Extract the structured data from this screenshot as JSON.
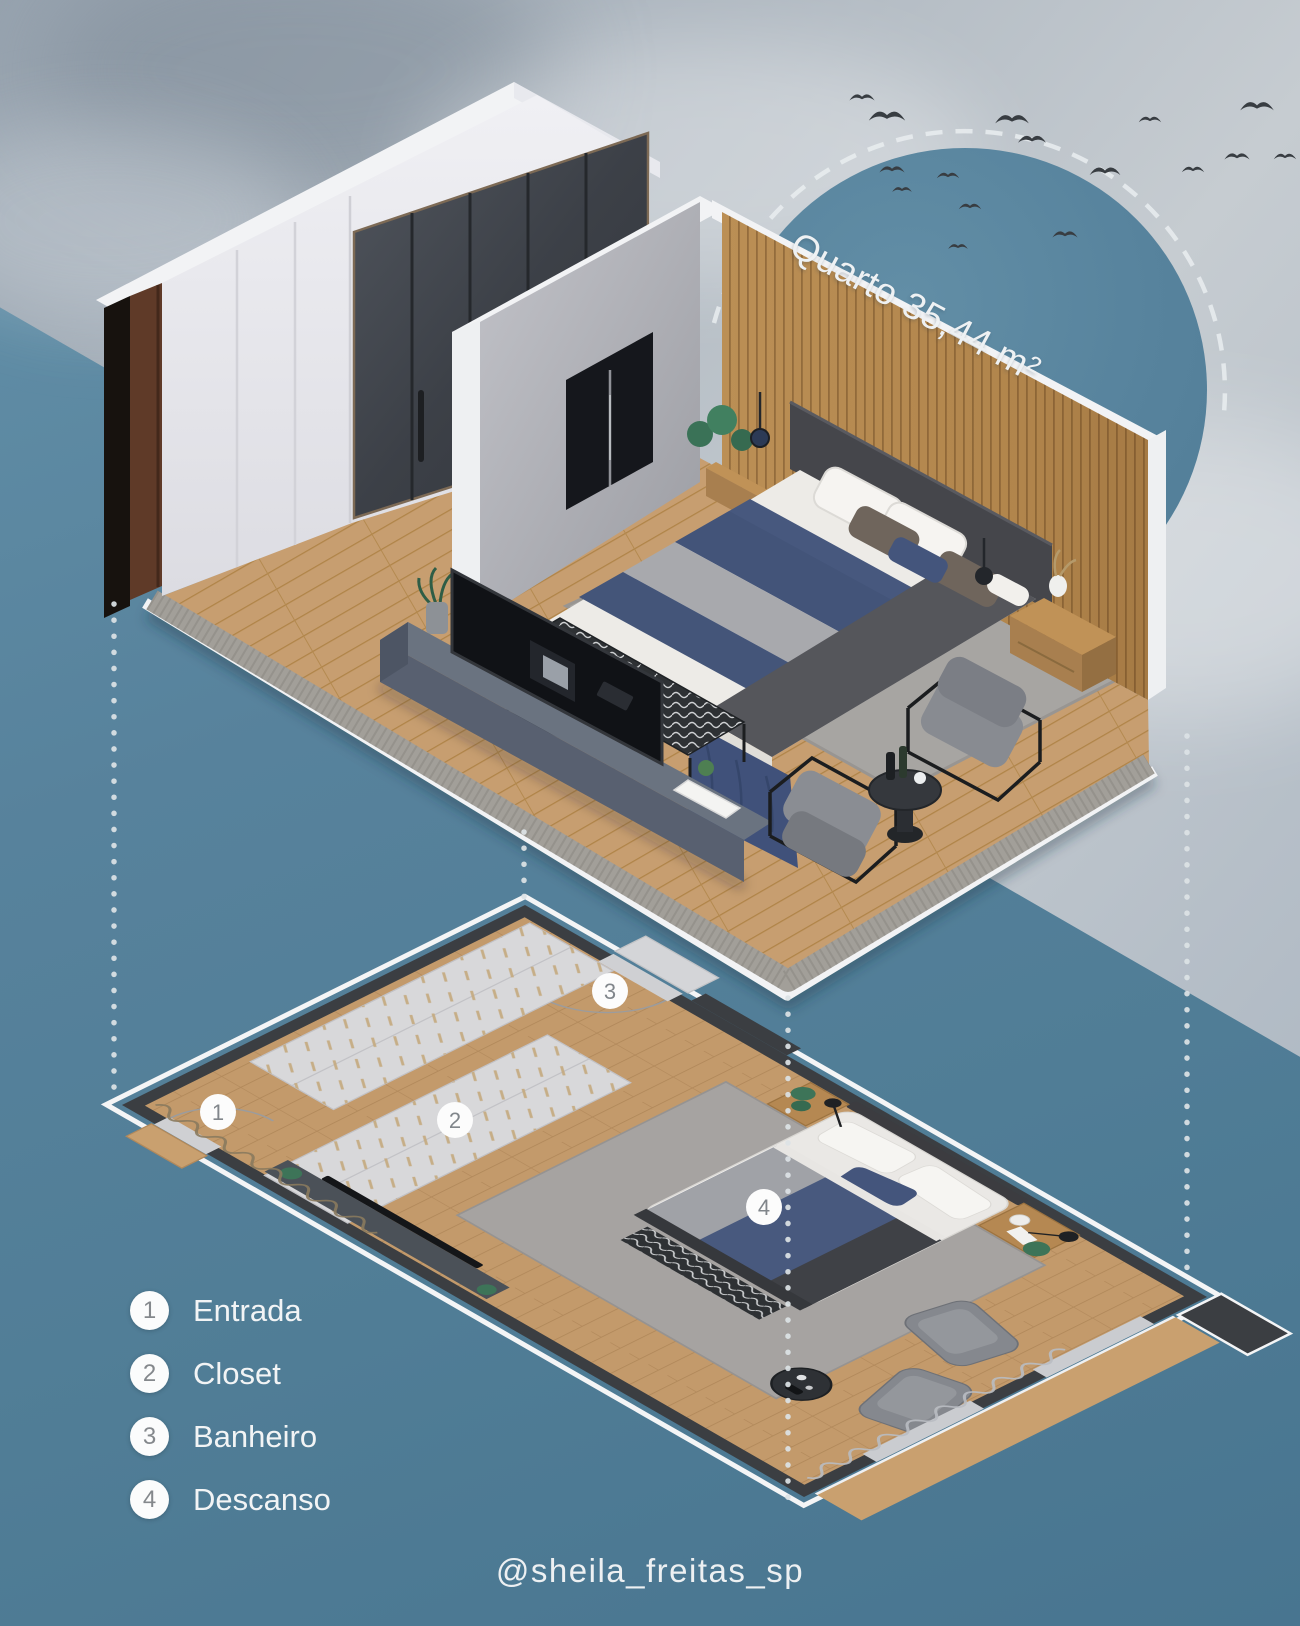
{
  "title": {
    "text": "Quarto 35,44 m²"
  },
  "legend": {
    "items": [
      {
        "number": "1",
        "label": "Entrada"
      },
      {
        "number": "2",
        "label": "Closet"
      },
      {
        "number": "3",
        "label": "Banheiro"
      },
      {
        "number": "4",
        "label": "Descanso"
      }
    ]
  },
  "plan": {
    "markers": [
      {
        "number": "1",
        "area": "Entrada"
      },
      {
        "number": "2",
        "area": "Closet"
      },
      {
        "number": "3",
        "area": "Banheiro"
      },
      {
        "number": "4",
        "area": "Descanso"
      }
    ]
  },
  "credit": {
    "handle": "@sheila_freitas_sp"
  },
  "colors": {
    "background_teal": "#54809b",
    "sky_gray": "#b9c1c9",
    "sun_circle_teal": "#57839d",
    "floor_wood": "#c79e70",
    "wood_slat_wall": "#b58950",
    "wall_white": "#e9e9ed",
    "closet_glass": "#464b52",
    "navy_bedding": "#47587e",
    "plan_wall_dark": "#3b3e42",
    "white_outline": "#f4f5f6",
    "badge_number_gray": "#84888c",
    "text_white": "#f2f4f5",
    "bird_silhouette": "#383d42"
  },
  "icons": {
    "birds": "bird-flock-silhouette",
    "legend_badge": "numbered-circle-badge",
    "plan_marker": "numbered-circle-badge",
    "dashed_arc": "dashed-arc-decoration",
    "dotted_connectors": "dotted-projection-lines"
  }
}
